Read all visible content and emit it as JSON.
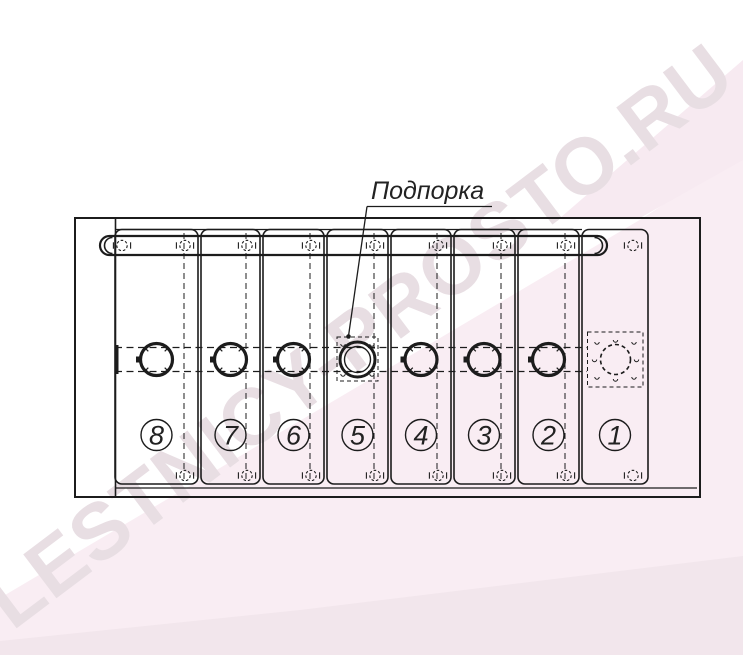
{
  "watermark": {
    "text": "LESTNICY-PROSTO.RU"
  },
  "label": {
    "text": "Подпорка"
  },
  "step_labels": [
    "8",
    "7",
    "6",
    "5",
    "4",
    "3",
    "2",
    "1"
  ],
  "colors": {
    "line": "#1c1c1c",
    "text": "#222222",
    "watermark": "#e8dee3",
    "pink_light": "#f9edf3",
    "pink_mid": "#f7eaf1",
    "pink_deep": "#f2e6ec",
    "bg": "#ffffff"
  }
}
